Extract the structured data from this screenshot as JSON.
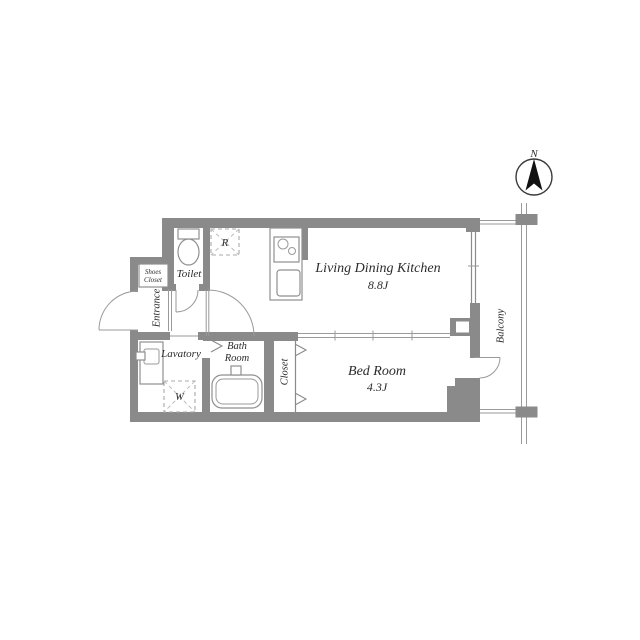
{
  "document": {
    "kind": "apartment-floor-plan",
    "background": "#ffffff"
  },
  "compass": {
    "north_label": "N"
  },
  "rooms": {
    "ldk": {
      "name": "Living Dining Kitchen",
      "area": "8.8J"
    },
    "bedroom": {
      "name": "Bed Room",
      "area": "4.3J"
    },
    "toilet": {
      "name": "Toilet"
    },
    "lavatory": {
      "name": "Lavatory"
    },
    "bathroom": {
      "line1": "Bath",
      "line2": "Room"
    },
    "closet": {
      "name": "Closet"
    },
    "entrance": {
      "name": "Entrance"
    },
    "shoes_closet": {
      "line1": "Shoes",
      "line2": "Closet"
    },
    "balcony": {
      "name": "Balcony"
    }
  },
  "fixtures": {
    "refrigerator": {
      "label": "R"
    },
    "washer": {
      "label": "W"
    }
  },
  "colors": {
    "wall": "#8a8a8a",
    "line": "#9a9a9a",
    "text": "#2b2b2b",
    "compass_arrow": "#111111",
    "background": "#ffffff"
  }
}
